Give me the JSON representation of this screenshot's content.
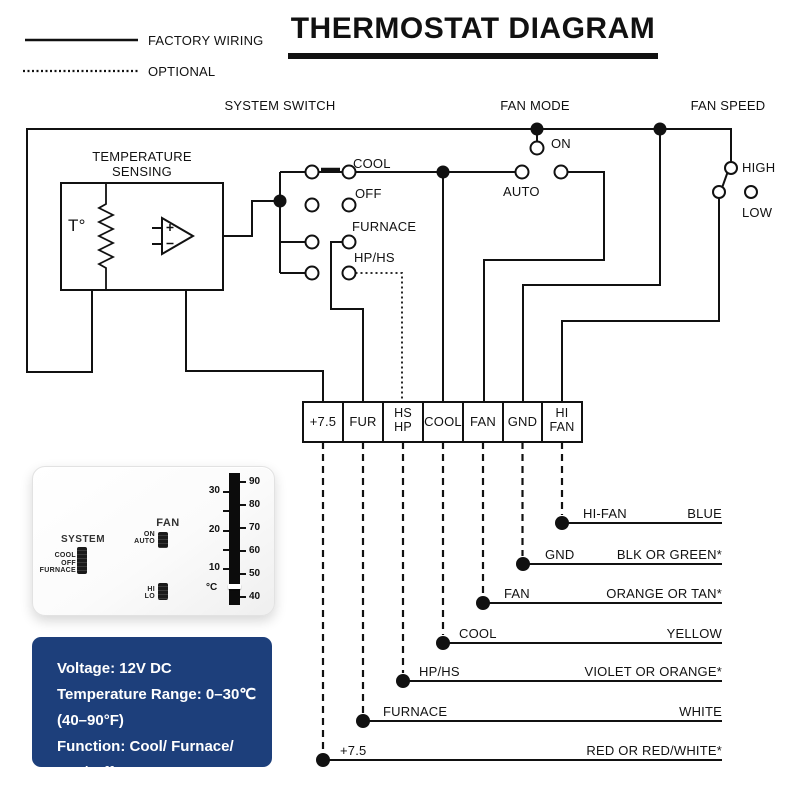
{
  "title": "THERMOSTAT DIAGRAM",
  "legend": {
    "factory_wiring": "FACTORY WIRING",
    "optional": "OPTIONAL"
  },
  "section_labels": {
    "system_switch": "SYSTEM SWITCH",
    "fan_mode": "FAN MODE",
    "fan_speed": "FAN SPEED"
  },
  "temperature_sensing": {
    "label_line1": "TEMPERATURE",
    "label_line2": "SENSING",
    "sensor": "T°"
  },
  "system_switch": {
    "positions": [
      "COOL",
      "OFF",
      "FURNACE",
      "HP/HS"
    ]
  },
  "fan_mode": {
    "on": "ON",
    "auto": "AUTO"
  },
  "fan_speed": {
    "high": "HIGH",
    "low": "LOW"
  },
  "terminal_strip": {
    "terminals": [
      [
        "+7.5"
      ],
      [
        "FUR"
      ],
      [
        "HS",
        "HP"
      ],
      [
        "COOL"
      ],
      [
        "FAN"
      ],
      [
        "GND"
      ],
      [
        "HI",
        "FAN"
      ]
    ]
  },
  "wire_table": [
    {
      "terminal": "HI-FAN",
      "color": "BLUE"
    },
    {
      "terminal": "GND",
      "color": "BLK OR GREEN*"
    },
    {
      "terminal": "FAN",
      "color": "ORANGE OR TAN*"
    },
    {
      "terminal": "COOL",
      "color": "YELLOW"
    },
    {
      "terminal": "HP/HS",
      "color": "VIOLET OR ORANGE*"
    },
    {
      "terminal": "FURNACE",
      "color": "WHITE"
    },
    {
      "terminal": "+7.5",
      "color": "RED OR RED/WHITE*"
    }
  ],
  "thermostat_device": {
    "system_label": "SYSTEM",
    "system_options": [
      "COOL",
      "OFF",
      "FURNACE"
    ],
    "fan_label": "FAN",
    "fan_options": [
      "ON",
      "AUTO"
    ],
    "fan_speed_options": [
      "HI",
      "LO"
    ],
    "scale_celsius": [
      "30",
      "20",
      "10"
    ],
    "scale_unit": "°C",
    "scale_fahrenheit": [
      "90",
      "80",
      "70",
      "60",
      "50",
      "40"
    ]
  },
  "info_box": {
    "background": "#1d3f7b",
    "lines": [
      "Voltage: 12V DC",
      "Temperature Range: 0–30℃",
      "(40–90°F)",
      "Function: Cool/ Furnace/",
      "Fan/ Off"
    ]
  },
  "colors": {
    "ink": "#111111",
    "background": "#ffffff"
  }
}
